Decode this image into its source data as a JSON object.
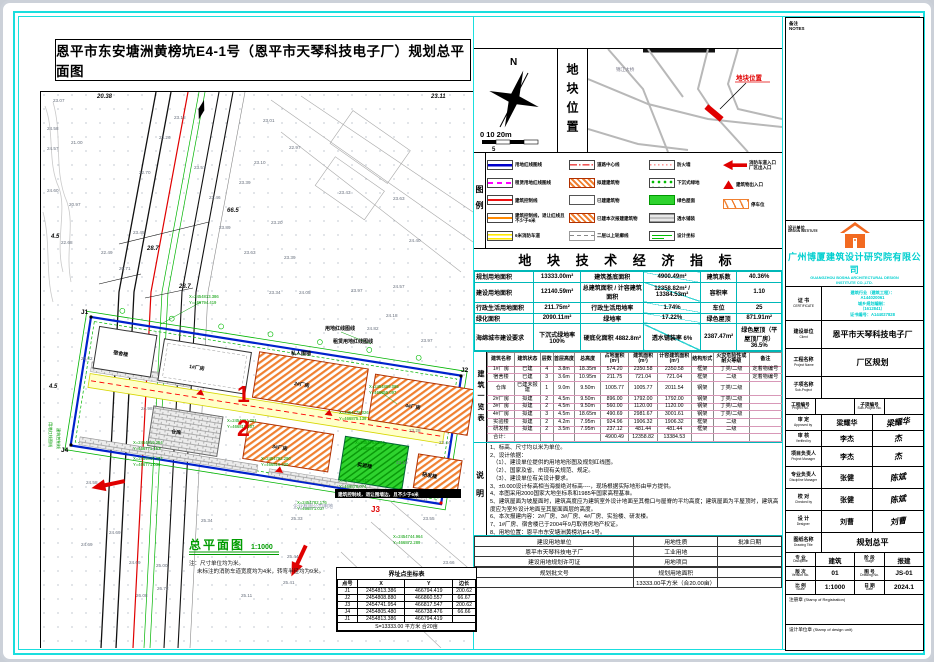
{
  "page": {
    "title": "恩平市东安塘洲黄榜坑E4-1号（恩平市天琴科技电子厂）规划总平面图"
  },
  "colors": {
    "frame": "#1adede",
    "cyan_text": "#00cfcf",
    "red": "#e00000",
    "green": "#009c00",
    "hatch_orange": "#f08030",
    "blue_line": "#0022cc"
  },
  "compass": {
    "n": "N",
    "scale_text": "0  10 20m",
    "scale_sub": "5"
  },
  "loc": {
    "title": "地块位置",
    "bridge": "锦江大桥",
    "site": "地块位置"
  },
  "legend": {
    "strip": "图例",
    "c1": [
      {
        "swatch": "line-blue",
        "label": "用地红线图线"
      },
      {
        "swatch": "dash-magenta",
        "label": "租赁用地红线图线"
      },
      {
        "swatch": "line-red",
        "label": "建筑控制线"
      },
      {
        "swatch": "line-orange",
        "label": "建筑控制线，退让红线且不少于6米"
      },
      {
        "swatch": "band-yellow",
        "label": "6米消防车道"
      }
    ],
    "c2": [
      {
        "swatch": "centerline-red",
        "label": "道路中心线"
      },
      {
        "swatch": "hatch-orange",
        "label": "拟建建筑物"
      },
      {
        "swatch": "rect-white",
        "label": "已建建筑物"
      },
      {
        "swatch": "hatch-orange",
        "label": "已建本次报建建筑物"
      },
      {
        "swatch": "dash-gray",
        "label": "二层以上轮廓线"
      }
    ],
    "c3": [
      {
        "swatch": "dot-pink",
        "label": "防火墙"
      },
      {
        "swatch": "green-dots",
        "label": "下沉式绿地"
      },
      {
        "swatch": "green-fill",
        "label": "绿色屋面"
      },
      {
        "swatch": "brick-gray",
        "label": "透水铺装"
      },
      {
        "swatch": "coord-green",
        "label": "设计坐标"
      }
    ],
    "c4": [
      {
        "swatch": "arrow-red",
        "label": "消防车道入口 厂区出入口"
      },
      {
        "swatch": "tri-red",
        "label": "建筑物出入口"
      },
      {
        "swatch": "zigzag-orange",
        "label": "停车位"
      }
    ]
  },
  "indicators": {
    "title": "地 块 技 术 经 济 指 标",
    "rows": [
      [
        "规划用地面积",
        "13333.00m²",
        "建筑基底面积",
        "4900.49m²",
        "建筑系数",
        "40.36%"
      ],
      [
        "建设用地面积",
        "12140.59m²",
        "总建筑面积 / 计容建筑面积",
        "12358.82m² / 13384.53m²",
        "容积率",
        "1.10"
      ],
      [
        "行政生活用地面积",
        "211.75m²",
        "行政生活用地率",
        "1.74%",
        "车位",
        "25"
      ],
      [
        "绿化面积",
        "2090.11m²",
        "绿地率",
        "17.22%",
        "绿色屋顶",
        "871.91m²"
      ],
      [
        "海绵城市建设要求",
        "下沉式绿地率 100%",
        "硬底化面积 4882.8m²",
        "透水铺装率 6%",
        "2387.47m²",
        "绿色屋顶（平屋顶厂房）36.5%"
      ]
    ]
  },
  "bt": {
    "strip": "建筑一览表",
    "head": [
      "建筑名称",
      "建筑状态",
      "层数",
      "首层高度",
      "总高度",
      "占地面积(m²)",
      "建筑面积(m²)",
      "计容建筑面积(m²)",
      "结构形式",
      "火灾危险性或耐火等级",
      "备注"
    ],
    "rows": [
      [
        "1#厂房",
        "已建",
        "4",
        "3.8m",
        "18.35m",
        "574.20",
        "2350.58",
        "2350.58",
        "框架",
        "丁类/二级",
        "定着物编号"
      ],
      [
        "宿舍楼",
        "已建",
        "3",
        "3.6m",
        "10.95m",
        "211.75",
        "721.04",
        "721.04",
        "框架",
        "二级",
        "定着物编号"
      ],
      [
        "仓库",
        "已建未报建",
        "1",
        "9.0m",
        "9.50m",
        "1005.77",
        "1005.77",
        "2011.54",
        "钢架",
        "丁类/二级",
        ""
      ],
      [
        "2#厂房",
        "拟建",
        "2",
        "4.5m",
        "9.50m",
        "896.00",
        "1792.00",
        "1792.00",
        "钢架",
        "丁类/二级",
        ""
      ],
      [
        "3#厂房",
        "拟建",
        "2",
        "4.5m",
        "9.50m",
        "560.00",
        "1120.00",
        "1120.00",
        "钢架",
        "丁类/二级",
        ""
      ],
      [
        "4#厂房",
        "拟建",
        "3",
        "4.5m",
        "18.65m",
        "490.69",
        "2981.67",
        "3001.61",
        "钢架",
        "丁类/二级",
        ""
      ],
      [
        "实验楼",
        "拟建",
        "2",
        "4.2m",
        "7.95m",
        "924.96",
        "1906.32",
        "1906.32",
        "框架",
        "二级",
        ""
      ],
      [
        "研发楼",
        "拟建",
        "2",
        "3.5m",
        "7.95m",
        "237.12",
        "481.44",
        "481.44",
        "框架",
        "二级",
        ""
      ],
      [
        "合计：",
        "",
        "",
        "",
        "",
        "4900.49",
        "12358.82",
        "13384.53",
        "",
        "",
        ""
      ]
    ]
  },
  "notes": {
    "strip": "说明",
    "lines": [
      "1、标高、尺寸均以米为单位。",
      "2、设计依据：",
      "　（1）、建设单位提供的用地地形图及规划红线图。",
      "　（2）、国家及省、市现有关规范、规定。",
      "　（3）、建设单位有关设计要求。",
      "3、±0.000设计标高相当海拔绝对标高----，现场根据实际地形由甲方提供。",
      "4、本图采用2000国家大地坐标系和1985年国家高程基准。",
      "5、建筑屋面为坡屋面时，建筑高度应为建筑室外设计地面至其檐口与屋脊的平均高度；建筑屋面为平屋顶时，建筑高度应为室外设计地面至其屋面面层的高度。",
      "6、本次报建内容：2#厂房、3#厂房、4#厂房、实验楼、研发楼。",
      "7、1#厂房、宿舍楼已于2004年9月取得房地产权证。",
      "8、用地位置：恩平市东安塘洲黄榜坑E4-1号。"
    ]
  },
  "approval": {
    "rows": [
      [
        "建设用地单位",
        "用地性质",
        "批准日期"
      ],
      [
        "恩平市天琴科技电子厂",
        "工业用地",
        ""
      ],
      [
        "建设用地规划许可证",
        "用地项目",
        ""
      ],
      [
        "",
        "",
        ""
      ],
      [
        "规划批文号",
        "规划用地面积",
        ""
      ],
      [
        "",
        "13333.00平方米（合20.00亩）",
        ""
      ]
    ]
  },
  "boundary": {
    "title": "界址点坐标表",
    "head": [
      "点号",
      "X",
      "Y",
      "边长"
    ],
    "rows": [
      [
        "J1",
        "2454813.386",
        "466794.419",
        "200.62"
      ],
      [
        "J2",
        "2454808.880",
        "466860.557",
        "66.67"
      ],
      [
        "J3",
        "2454741.954",
        "466817.547",
        "200.62"
      ],
      [
        "J4",
        "2454805.480",
        "466738.476",
        "66.66"
      ],
      [
        "J1",
        "2454813.386",
        "466794.419",
        ""
      ],
      [
        "S=13333.00 平方米 合20亩"
      ]
    ]
  },
  "plan": {
    "title": "总平面图",
    "scale": "1:1000",
    "note1": "注：尺寸单位均为米。",
    "note2": "未标注的消防车道宽度均为4米，转弯半径均为9米。",
    "els": [
      {
        "x": 12,
        "y": 10,
        "t": "23.07"
      },
      {
        "x": 6,
        "y": 38,
        "t": "24.58"
      },
      {
        "x": 30,
        "y": 52,
        "t": "21.00"
      },
      {
        "x": 6,
        "y": 58,
        "t": "24.57"
      },
      {
        "x": 6,
        "y": 100,
        "t": "24.60"
      },
      {
        "x": 28,
        "y": 114,
        "t": "20.97"
      },
      {
        "x": 20,
        "y": 152,
        "t": "22.68"
      },
      {
        "x": 60,
        "y": 162,
        "t": "22.49"
      },
      {
        "x": 92,
        "y": 142,
        "t": "23.45"
      },
      {
        "x": 78,
        "y": 178,
        "t": "20.71"
      },
      {
        "x": 98,
        "y": 82,
        "t": "22.70"
      },
      {
        "x": 133,
        "y": 27,
        "t": "23.18"
      },
      {
        "x": 118,
        "y": 47,
        "t": "23.26"
      },
      {
        "x": 153,
        "y": 77,
        "t": "23.57"
      },
      {
        "x": 168,
        "y": 107,
        "t": "23.46"
      },
      {
        "x": 178,
        "y": 137,
        "t": "23.89"
      },
      {
        "x": 198,
        "y": 92,
        "t": "23.39"
      },
      {
        "x": 213,
        "y": 72,
        "t": "23.10"
      },
      {
        "x": 222,
        "y": 30,
        "t": "23.01"
      },
      {
        "x": 248,
        "y": 57,
        "t": "22.97"
      },
      {
        "x": 230,
        "y": 132,
        "t": "23.20"
      },
      {
        "x": 203,
        "y": 162,
        "t": "23.63"
      },
      {
        "x": 243,
        "y": 167,
        "t": "23.39"
      },
      {
        "x": 258,
        "y": 202,
        "t": "24.05"
      },
      {
        "x": 228,
        "y": 202,
        "t": "23.34"
      },
      {
        "x": 298,
        "y": 102,
        "t": "23.43"
      },
      {
        "x": 352,
        "y": 108,
        "t": "23.63"
      },
      {
        "x": 368,
        "y": 150,
        "t": "24.40"
      },
      {
        "x": 352,
        "y": 196,
        "t": "24.57"
      },
      {
        "x": 326,
        "y": 238,
        "t": "24.82"
      },
      {
        "x": 380,
        "y": 250,
        "t": "23.97"
      },
      {
        "x": 40,
        "y": 268,
        "t": "25.02"
      },
      {
        "x": 100,
        "y": 318,
        "t": "24.98"
      },
      {
        "x": 45,
        "y": 392,
        "t": "24.58"
      },
      {
        "x": 68,
        "y": 442,
        "t": "24.69"
      },
      {
        "x": 40,
        "y": 454,
        "t": "24.69"
      },
      {
        "x": 88,
        "y": 472,
        "t": "24.69"
      },
      {
        "x": 160,
        "y": 430,
        "t": "25.34"
      },
      {
        "x": 250,
        "y": 428,
        "t": "25.33"
      },
      {
        "x": 246,
        "y": 466,
        "t": "25.44"
      },
      {
        "x": 242,
        "y": 492,
        "t": "25.41"
      },
      {
        "x": 115,
        "y": 475,
        "t": "25.00"
      },
      {
        "x": 116,
        "y": 498,
        "t": "26.72"
      },
      {
        "x": 95,
        "y": 505,
        "t": "26.08"
      },
      {
        "x": 200,
        "y": 505,
        "t": "25.11"
      },
      {
        "x": 305,
        "y": 478,
        "t": "25.83"
      },
      {
        "x": 330,
        "y": 478,
        "t": "25.31"
      },
      {
        "x": 368,
        "y": 340,
        "t": "23.28"
      },
      {
        "x": 398,
        "y": 352,
        "t": "23.44"
      },
      {
        "x": 355,
        "y": 372,
        "t": "23.10"
      },
      {
        "x": 382,
        "y": 428,
        "t": "23.55"
      },
      {
        "x": 402,
        "y": 472,
        "t": "23.66"
      },
      {
        "x": 345,
        "y": 225,
        "t": "24.18"
      },
      {
        "x": 310,
        "y": 200,
        "t": "23.97"
      }
    ],
    "coords": [
      {
        "x": 148,
        "y": 206,
        "t": "X=2454813.386",
        "c": "cg"
      },
      {
        "x": 148,
        "y": 212,
        "t": "Y=466794.419",
        "c": "cg"
      },
      {
        "x": 92,
        "y": 352,
        "t": "X=2454819.254",
        "c": "cg"
      },
      {
        "x": 92,
        "y": 358,
        "t": "Y=466771.157",
        "c": "cg"
      },
      {
        "x": 92,
        "y": 368,
        "t": "X=2454816.254",
        "c": "cg"
      },
      {
        "x": 92,
        "y": 374,
        "t": "Y=466771.035",
        "c": "cg"
      },
      {
        "x": 186,
        "y": 330,
        "t": "X=2454791.291",
        "c": "cg"
      },
      {
        "x": 186,
        "y": 336,
        "t": "Y=466815.107",
        "c": "cg"
      },
      {
        "x": 220,
        "y": 368,
        "t": "X=2454792.290",
        "c": "cg"
      },
      {
        "x": 220,
        "y": 374,
        "t": "Y=466816.420",
        "c": "cg"
      },
      {
        "x": 328,
        "y": 296,
        "t": "X=2454809.085",
        "c": "cg"
      },
      {
        "x": 328,
        "y": 302,
        "t": "Y=466855.097",
        "c": "cg"
      },
      {
        "x": 298,
        "y": 322,
        "t": "X=2454778.026",
        "c": "cg"
      },
      {
        "x": 298,
        "y": 328,
        "t": "Y=466875.139",
        "c": "cg"
      },
      {
        "x": 314,
        "y": 352,
        "t": "X=2454763.282",
        "c": "cg"
      },
      {
        "x": 314,
        "y": 358,
        "t": "Y=466876.907",
        "c": "cg"
      },
      {
        "x": 298,
        "y": 390,
        "t": "X=2454790.449",
        "c": "cg"
      },
      {
        "x": 298,
        "y": 396,
        "t": "Y=466876.074",
        "c": "cg"
      },
      {
        "x": 256,
        "y": 412,
        "t": "X=2454782.176",
        "c": "cg"
      },
      {
        "x": 256,
        "y": 418,
        "t": "Y=466871.037",
        "c": "cg"
      },
      {
        "x": 352,
        "y": 446,
        "t": "X=2454744.964",
        "c": "cg"
      },
      {
        "x": 352,
        "y": 452,
        "t": "Y=466872.289",
        "c": "cg"
      }
    ],
    "dims": [
      {
        "x": 186,
        "y": 120,
        "t": "66.5",
        "c": "dim"
      },
      {
        "x": 106,
        "y": 158,
        "t": "28.7",
        "c": "dim"
      },
      {
        "x": 138,
        "y": 196,
        "t": "28.7",
        "c": "dim"
      },
      {
        "x": 10,
        "y": 146,
        "t": "4.5",
        "c": "dim"
      },
      {
        "x": 8,
        "y": 296,
        "t": "4.5",
        "c": "dim"
      },
      {
        "x": 56,
        "y": 6,
        "t": "20.38",
        "c": "dim"
      },
      {
        "x": 390,
        "y": 6,
        "t": "23.11",
        "c": "dim"
      }
    ],
    "marks": [
      {
        "x": 196,
        "y": 310,
        "t": "1",
        "c": "red1"
      },
      {
        "x": 196,
        "y": 344,
        "t": "2",
        "c": "red1"
      },
      {
        "x": 330,
        "y": 420,
        "t": "J3",
        "c": "redS"
      },
      {
        "x": 40,
        "y": 222,
        "t": "J1",
        "c": "jm"
      },
      {
        "x": 420,
        "y": 280,
        "t": "J2",
        "c": "jm"
      },
      {
        "x": 20,
        "y": 360,
        "t": "J4",
        "c": "jm"
      }
    ],
    "blds": [
      {
        "x": 72,
        "y": 262,
        "t": "宿舍楼",
        "c": "bl",
        "r": 9
      },
      {
        "x": 148,
        "y": 276,
        "t": "1#厂房",
        "c": "bl",
        "r": 9
      },
      {
        "x": 253,
        "y": 293,
        "t": "2#厂房",
        "c": "bl",
        "r": 9
      },
      {
        "x": 364,
        "y": 315,
        "t": "4#厂房",
        "c": "bl",
        "r": 9
      },
      {
        "x": 130,
        "y": 341,
        "t": "仓库",
        "c": "bl",
        "r": 9
      },
      {
        "x": 231,
        "y": 356,
        "t": "3#厂房",
        "c": "bl",
        "r": 9
      },
      {
        "x": 316,
        "y": 374,
        "t": "实验楼",
        "c": "bl",
        "r": 9
      },
      {
        "x": 381,
        "y": 384,
        "t": "研发楼",
        "c": "bl",
        "r": 9
      }
    ],
    "calls": [
      {
        "x": 284,
        "y": 238,
        "t": "用地红线图线",
        "c": "bl"
      },
      {
        "x": 292,
        "y": 251,
        "t": "租赁用地红线图线",
        "c": "bl"
      },
      {
        "x": 250,
        "y": 263,
        "t": "私人围墙",
        "c": "bl"
      },
      {
        "x": 297,
        "y": 404,
        "t": "建筑控制线，退让围墙边，且不少于6米",
        "c": "blw"
      },
      {
        "x": 252,
        "y": 416,
        "t": "企业有限公司用地",
        "c": "gry"
      },
      {
        "x": 8,
        "y": 330,
        "t": "用地红线图线",
        "c": "cg",
        "r": 90
      },
      {
        "x": 16,
        "y": 336,
        "t": "建筑控制线",
        "c": "cg",
        "r": 90
      }
    ]
  },
  "tb": {
    "note1": "备注",
    "note2": "NOTES",
    "design_unit_label": "设计单位",
    "design_unit_en": "DESIGN INSTITUTE",
    "company_cn": "广州博厦建筑设计研究院有限公司",
    "company_en1": "GUANGZHOU BOSHA ARCHITECTURAL DESIGN",
    "company_en2": "INSTITUTE CO.,LTD.",
    "cert_label": "证 书",
    "cert_en": "CERTIFICATE",
    "cert_lines": [
      "建筑行业（建筑工程）：",
      "A144020061",
      "城乡规划编制：",
      "（1612841）",
      "证书编号：A144027828"
    ],
    "client_label": "建设单位",
    "client_en": "Client",
    "client": "恩平市天琴科技电子厂",
    "project_label": "工程名称",
    "project_en": "Project Name",
    "project": "厂区规划",
    "sub_label": "子项名称",
    "sub_en": "Sub-Project",
    "sub": "",
    "projno_label": "工程编号",
    "projno_en": "Project No.",
    "subno_label": "子项编号",
    "subno_en": "Sub-Project No.",
    "approved_label": "审 定",
    "approved_en": "Approved by",
    "approved_name": "梁耀华",
    "approved_sig": "梁耀华",
    "verified_label": "审 核",
    "verified_en": "Verified by",
    "verified_name": "李杰",
    "verified_sig": "杰",
    "pm_label": "项目负责人",
    "pm_en": "Project Manager",
    "pm_name": "李杰",
    "pm_sig": "杰",
    "dm_label": "专业负责人",
    "dm_en": "Discipline Manager",
    "dm_name": "张健",
    "dm_sig": "陈斌",
    "checked_label": "校 对",
    "checked_en": "Checked by",
    "checked_name": "张健",
    "checked_sig": "陈斌",
    "designer_label": "设 计",
    "designer_en": "Designer",
    "designer_name": "刘曹",
    "designer_sig": "刘曹",
    "drawing_label": "图纸名称",
    "drawing_en": "Drawing Title",
    "drawing": "规划总平",
    "discipline_label": "专 业",
    "discipline_en": "Discipline",
    "discipline": "建筑",
    "stage_label": "阶 段",
    "stage_en": "Stage",
    "stage": "报建",
    "version_label": "版 次",
    "version_en": "Version No.",
    "version": "01",
    "drawno_label": "图 号",
    "drawno_en": "Drawing No.",
    "drawno": "JS-01",
    "scale_label": "比 例",
    "scale_en": "Scale",
    "scale": "1:1000",
    "date_label": "日 期",
    "date_en": "Date",
    "date": "2024.1",
    "stamp_reg": "注册章",
    "stamp_reg_en": "(Stamp of Registration)",
    "stamp_unit": "设计单位章",
    "stamp_unit_en": "(Stamp of design unit)"
  }
}
